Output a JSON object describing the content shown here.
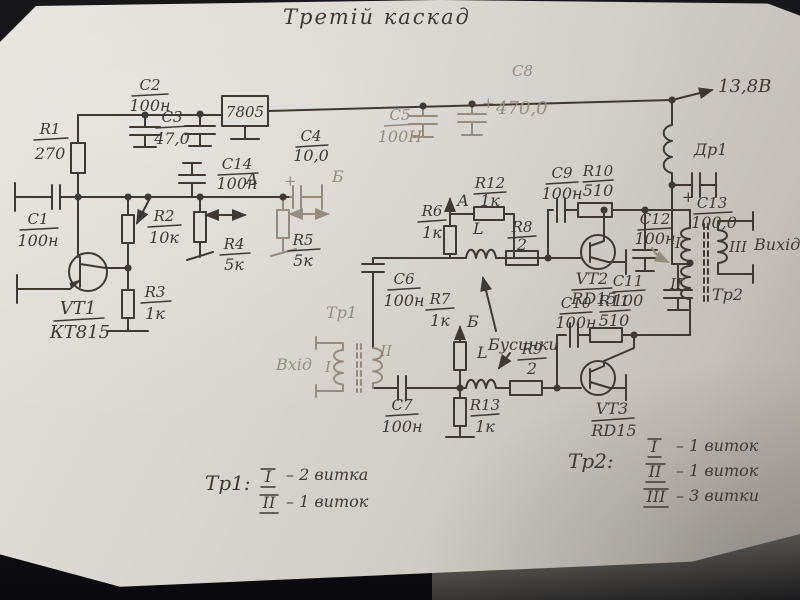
{
  "title": "Третій каскад",
  "supply": "13,8В",
  "regulator": "7805",
  "choke": "Др1",
  "input_label": "Вхід",
  "output_label": "Вихід",
  "beads_label": "Бусинки",
  "bead_l": "L",
  "plus": "+",
  "point_a": "А",
  "point_b": "Б",
  "tr1_name": "Тр1",
  "tr2_name": "Тр2",
  "tr1_w1": "I",
  "tr1_w2": "II",
  "tr2_w1": "I",
  "tr2_w2": "II",
  "tr2_w3": "III",
  "components": {
    "c1": {
      "ref": "C1",
      "value": "100н"
    },
    "c2": {
      "ref": "C2",
      "value": "100н"
    },
    "c3": {
      "ref": "C3",
      "value": "47,0"
    },
    "c4": {
      "ref": "C4",
      "value": "10,0"
    },
    "c5": {
      "ref": "C5",
      "value": "100Н"
    },
    "c6": {
      "ref": "C6",
      "value": "100н"
    },
    "c7": {
      "ref": "C7",
      "value": "100н"
    },
    "c8": {
      "ref": "C8",
      "value": "470,0"
    },
    "c9": {
      "ref": "C9",
      "value": "100н"
    },
    "c10": {
      "ref": "C10",
      "value": "100н"
    },
    "c11": {
      "ref": "C11",
      "value": "100"
    },
    "c12": {
      "ref": "C12",
      "value": "100н"
    },
    "c13": {
      "ref": "C13",
      "value": "100,0"
    },
    "c14": {
      "ref": "C14",
      "value": "100н"
    },
    "r1": {
      "ref": "R1",
      "value": "270"
    },
    "r2": {
      "ref": "R2",
      "value": "10к"
    },
    "r3": {
      "ref": "R3",
      "value": "1к"
    },
    "r4": {
      "ref": "R4",
      "value": "5к"
    },
    "r5": {
      "ref": "R5",
      "value": "5к"
    },
    "r6": {
      "ref": "R6",
      "value": "1к"
    },
    "r7": {
      "ref": "R7",
      "value": "1к"
    },
    "r8": {
      "ref": "R8",
      "value": "2"
    },
    "r9": {
      "ref": "R9",
      "value": "2"
    },
    "r10": {
      "ref": "R10",
      "value": "510"
    },
    "r11": {
      "ref": "R11",
      "value": "510"
    },
    "r12": {
      "ref": "R12",
      "value": "1к"
    },
    "r13": {
      "ref": "R13",
      "value": "1к"
    },
    "vt1": {
      "ref": "VT1",
      "value": "КТ815"
    },
    "vt2": {
      "ref": "VT2",
      "value": "RD15"
    },
    "vt3": {
      "ref": "VT3",
      "value": "RD15"
    }
  },
  "legend_tr1": {
    "title": "Тр1:",
    "rows": [
      {
        "n": "I",
        "t": "– 2 витка"
      },
      {
        "n": "II",
        "t": "– 1 виток"
      }
    ]
  },
  "legend_tr2": {
    "title": "Тр2:",
    "rows": [
      {
        "n": "I",
        "t": "– 1 виток"
      },
      {
        "n": "II",
        "t": "– 1 виток"
      },
      {
        "n": "III",
        "t": "– 3 витки"
      }
    ]
  }
}
